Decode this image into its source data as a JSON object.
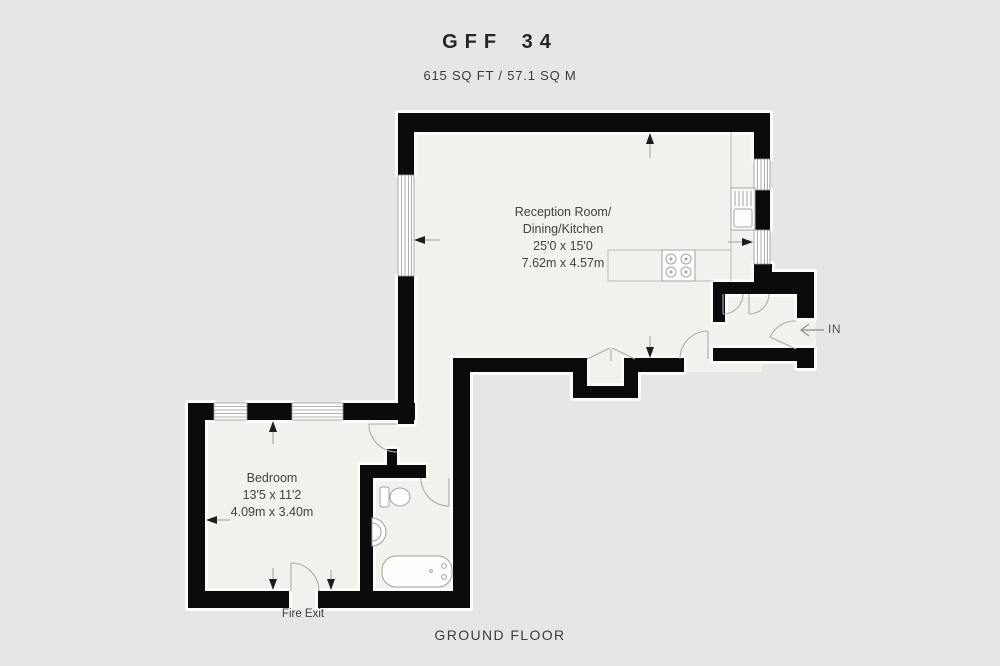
{
  "theme": {
    "bg": "#e7e6e4",
    "floor": "#f2f1ee",
    "wall": "#0b0b0b",
    "halo": "#fbfbfa",
    "line": "#b6b5b2",
    "fixture": "#a5a4a1",
    "arrow": "#1c1c1c",
    "text": "#3e3e3c",
    "title": "#262624"
  },
  "header": {
    "title": "GFF 34",
    "area": "615 SQ FT / 57.1 SQ M"
  },
  "rooms": {
    "reception": {
      "name_line1": "Reception Room/",
      "name_line2": "Dining/Kitchen",
      "dims_imperial": "25'0 x 15'0",
      "dims_metric": "7.62m x 4.57m"
    },
    "bedroom": {
      "name": "Bedroom",
      "dims_imperial": "13'5 x 11'2",
      "dims_metric": "4.09m x 3.40m"
    }
  },
  "labels": {
    "fire_exit": "Fire Exit",
    "entrance": "IN",
    "floor_name": "GROUND FLOOR"
  }
}
